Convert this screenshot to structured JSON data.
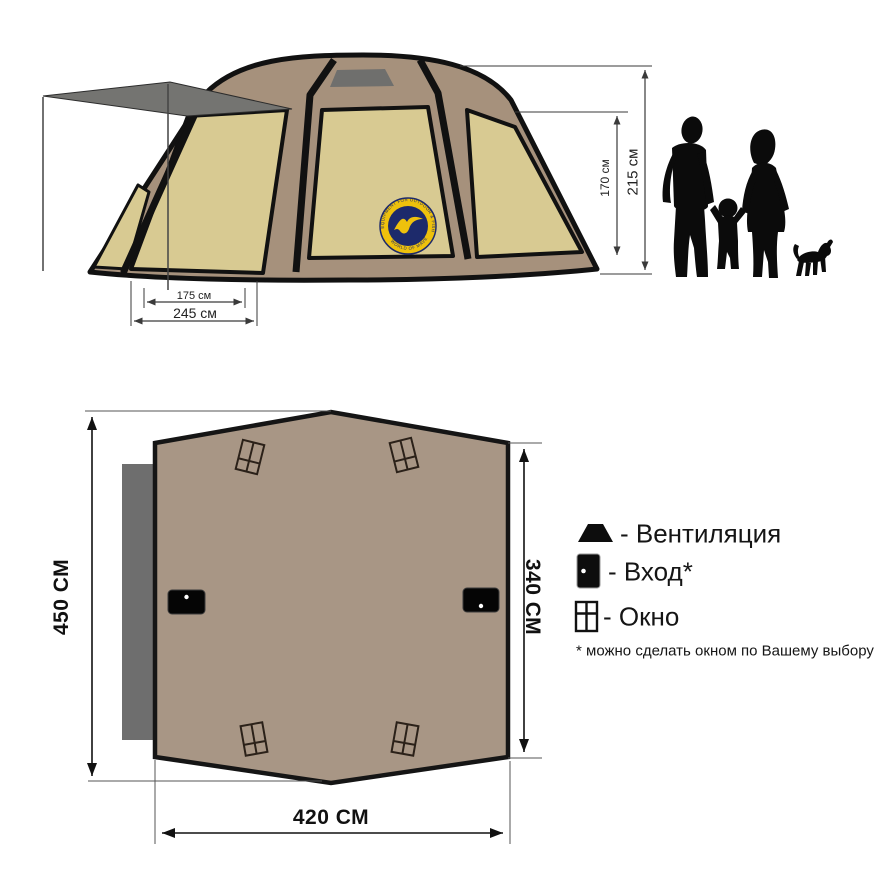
{
  "side_view": {
    "dim_inner": "175 см",
    "dim_outer": "245 см",
    "dim_wall": "170 см",
    "dim_height": "215 см"
  },
  "plan": {
    "dim_length": "450 СМ",
    "dim_width": "340 СМ",
    "dim_front": "420 СМ"
  },
  "legend": {
    "ventilation": "- Вентиляция",
    "entrance": "- Вход*",
    "window": "- Окно",
    "footnote": "* можно сделать окном по Вашему выбору"
  },
  "logo": {
    "top_text": "EQUIPMENT FOR OUTDOOR & FISHING",
    "bottom_text": "WORLD OF MAVERICK"
  },
  "colors": {
    "tent_frame": "#a6917c",
    "tent_panel": "#d8ca92",
    "vent_grey": "#6f6f6d",
    "awning_grey": "#747471",
    "plan_fill": "#a89685",
    "plan_awning_grey": "#6e6e6e",
    "logo_blue": "#1d2a6b",
    "logo_yellow": "#eec10c",
    "silhouette_black": "#0b0b0b"
  }
}
